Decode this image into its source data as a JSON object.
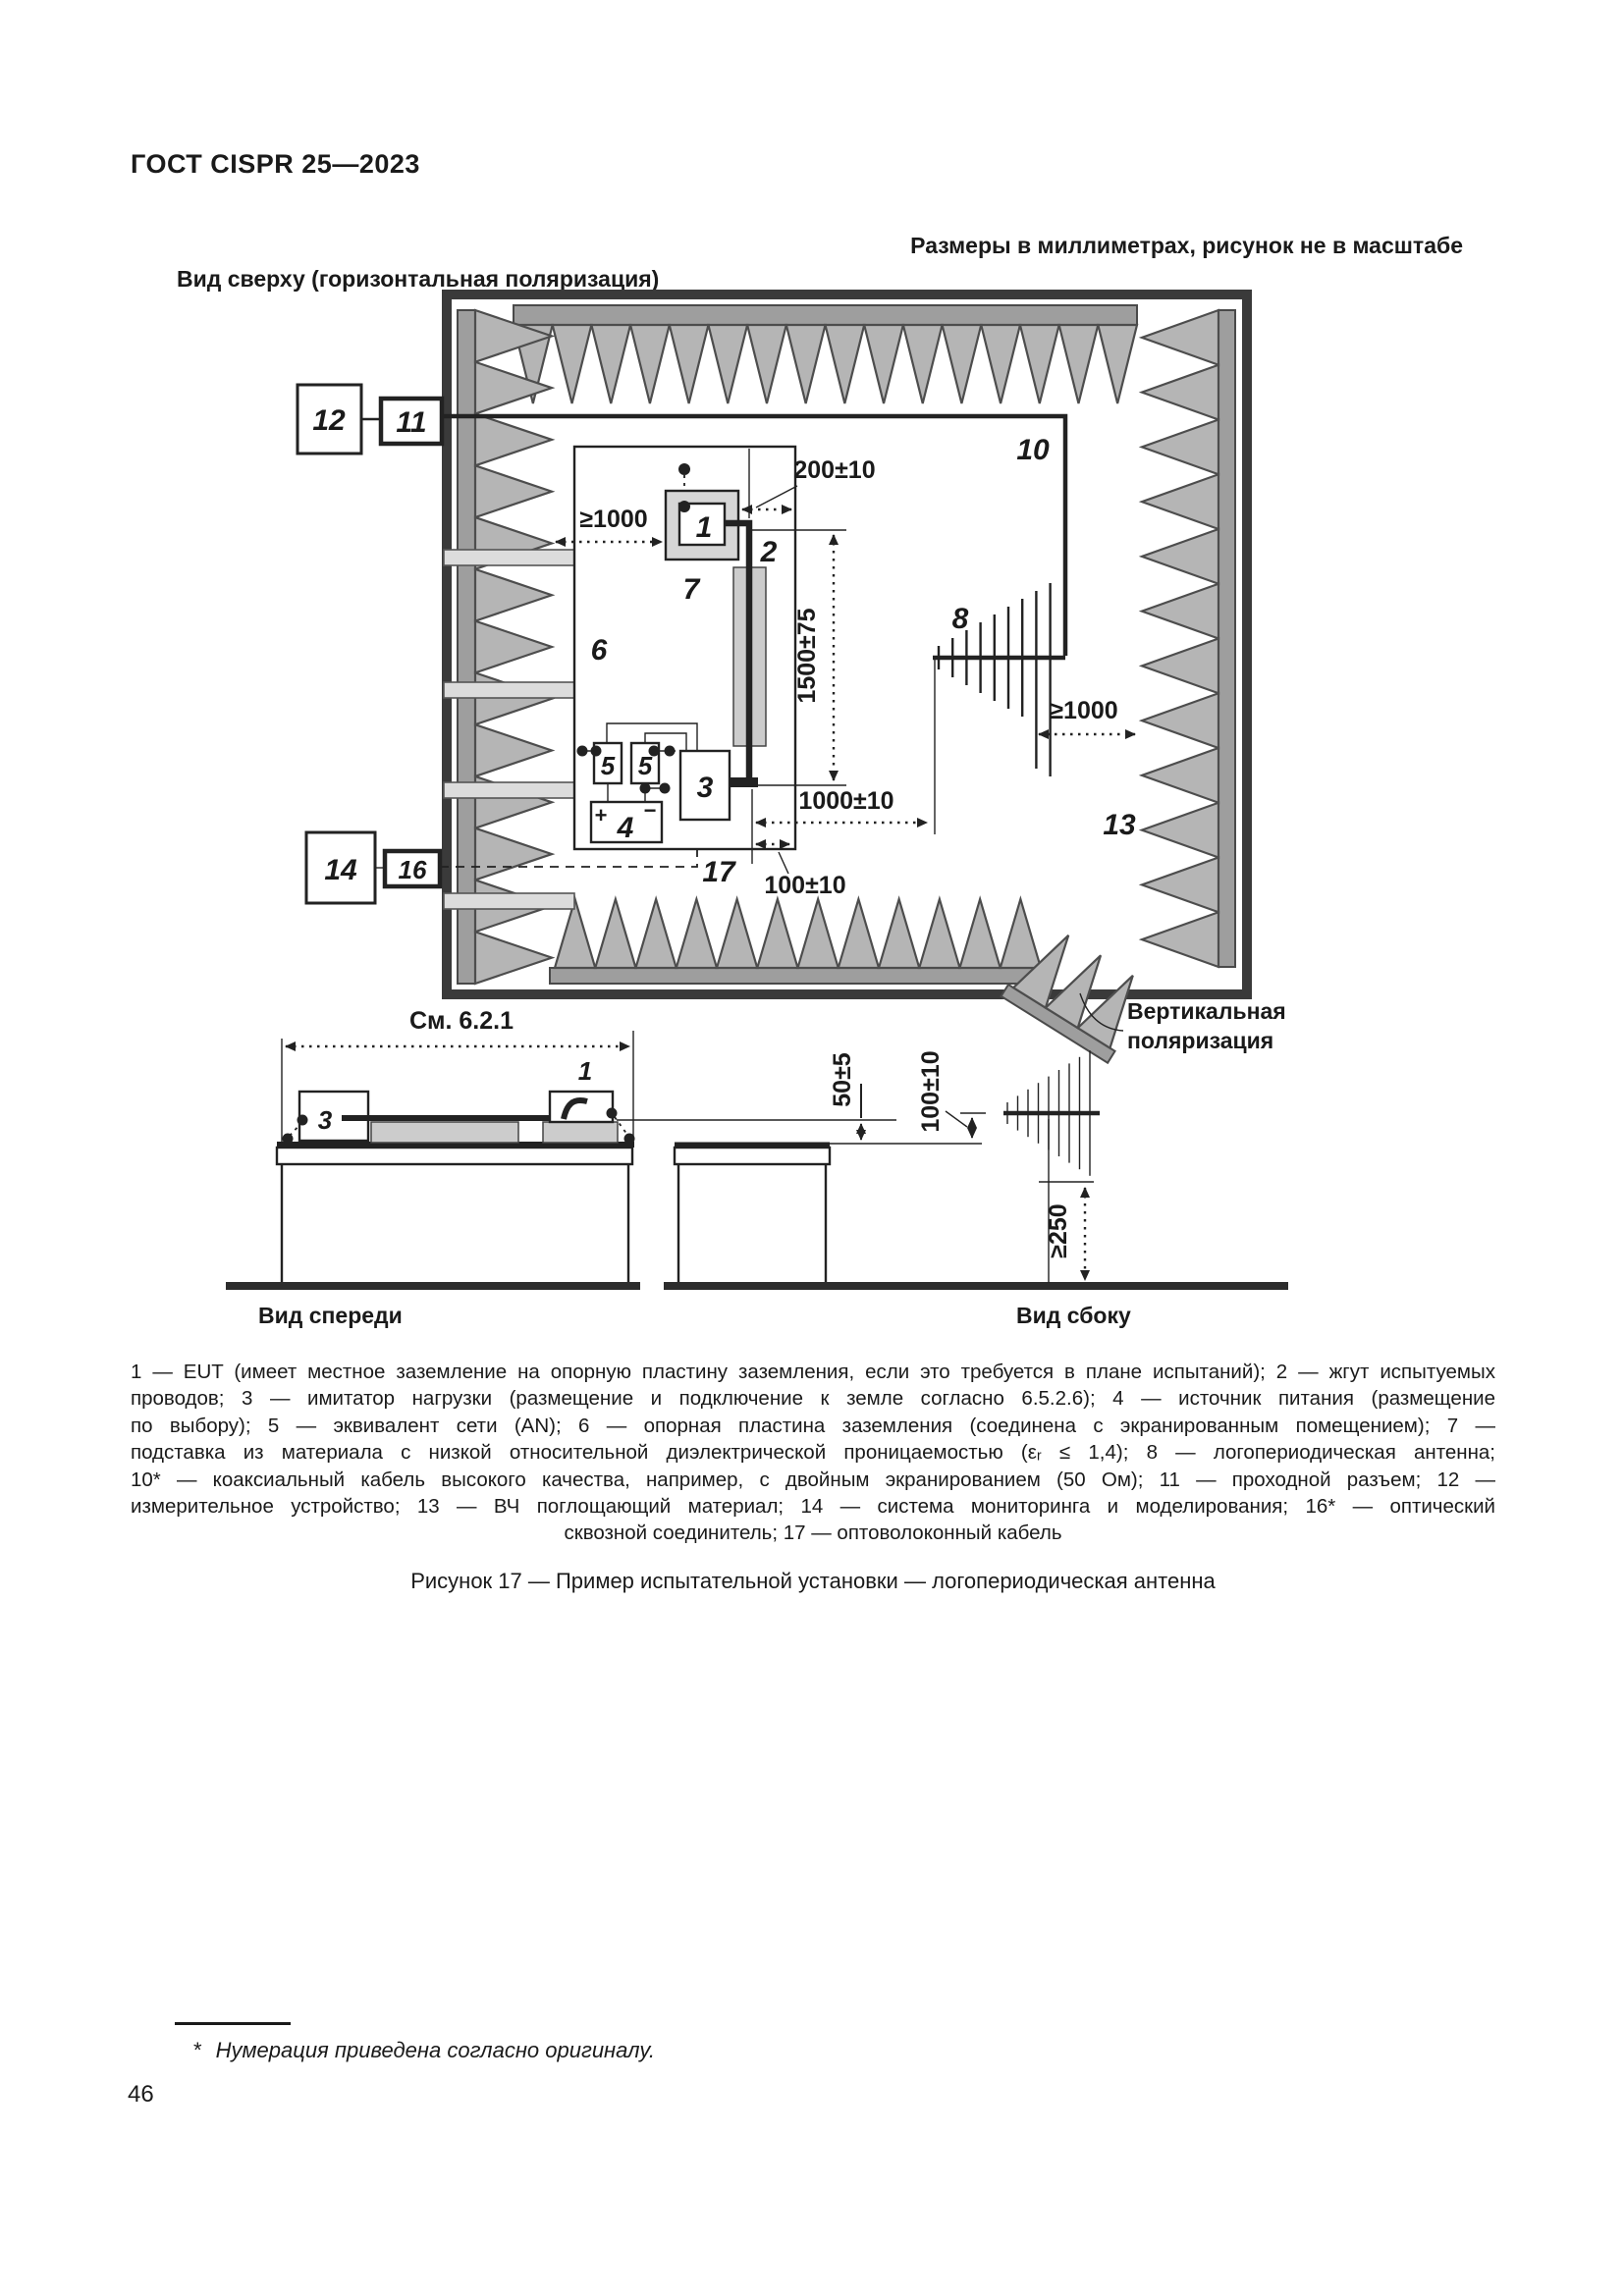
{
  "page": {
    "header": "ГОСТ CISPR 25—2023",
    "page_number": "46"
  },
  "figure": {
    "view_top_label": "Вид сверху (горизонтальная поляризация)",
    "units_note": "Размеры в миллиметрах, рисунок не в масштабе",
    "view_front_label": "Вид спереди",
    "view_side_label": "Вид сбоку",
    "vertical_polarization_line1": "Вертикальная",
    "vertical_polarization_line2": "поляризация",
    "see_ref": "См. 6.2.1",
    "plus": "+",
    "minus": "−",
    "items": {
      "n1": "1",
      "n2": "2",
      "n3": "3",
      "n4": "4",
      "n5": "5",
      "n6": "6",
      "n7": "7",
      "n8": "8",
      "n10": "10",
      "n11": "11",
      "n12": "12",
      "n13": "13",
      "n14": "14",
      "n16": "16",
      "n17": "17"
    },
    "dims": {
      "d200": "200±10",
      "d1000min_left": "≥1000",
      "d1500": "1500±75",
      "d1000": "1000±10",
      "d100": "100±10",
      "d1000min_right": "≥1000",
      "d50": "50±5",
      "d100v": "100±10",
      "d250": "≥250"
    }
  },
  "legend": {
    "lines": [
      "1 — EUT (имеет местное заземление на опорную пластину заземления, если это требуется в плане испытаний); 2 — жгут испытуемых",
      "проводов; 3 — имитатор нагрузки (размещение и подключение к земле согласно 6.5.2.6); 4 — источник питания (размещение",
      "по выбору); 5 — эквивалент сети (AN); 6 — опорная пластина заземления (соединена с экранированным помещением); 7 —",
      "подставка из материала с низкой относительной диэлектрической проницаемостью (εᵣ ≤ 1,4); 8 — логопериодическая антенна;",
      "10* — коаксиальный кабель высокого качества, например, с двойным экранированием (50 Ом); 11 — проходной разъем; 12 —",
      "измерительное устройство; 13 — ВЧ поглощающий материал; 14 — система мониторинга и моделирования; 16* — оптический",
      "сквозной соединитель; 17 — оптоволоконный кабель"
    ]
  },
  "caption": "Рисунок 17 — Пример испытательной установки — логопериодическая антенна",
  "footnote": {
    "star": "*",
    "text": "Нумерация приведена согласно оригиналу."
  }
}
